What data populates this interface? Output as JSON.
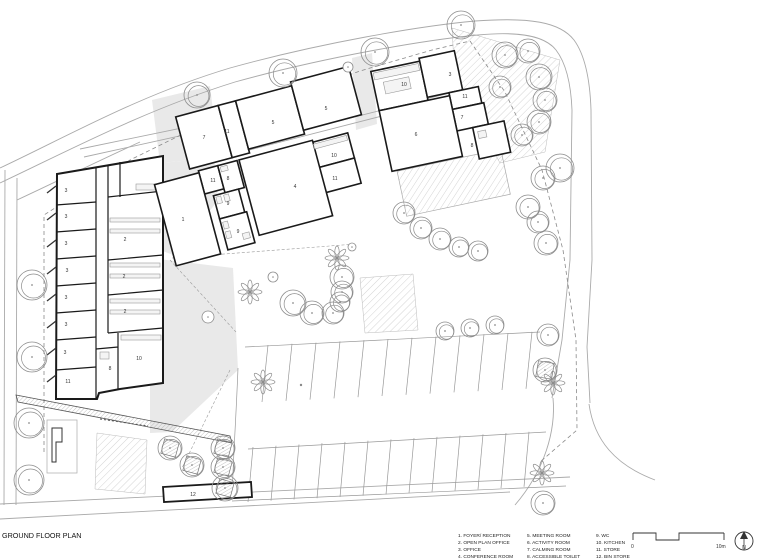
{
  "sheet": {
    "title": "GROUND FLOOR PLAN"
  },
  "legend": {
    "columns": [
      {
        "items": [
          "1. FOYER/ RECEPTION",
          "2. OPEN PLAN OFFICE",
          "3. OFFICE",
          "4. CONFERENCE ROOM"
        ]
      },
      {
        "items": [
          "5. MEETING ROOM",
          "6. ACTIVITY ROOM",
          "7. CALMING ROOM",
          "8. ACCESSIBLE TOILET"
        ]
      },
      {
        "items": [
          "9. WC",
          "10. KITCHEN",
          "11. STORE",
          "12. BIN STORE"
        ]
      }
    ]
  },
  "scale_bar": {
    "start_label": "0",
    "end_label": "10m"
  },
  "north_arrow": {
    "label": "N"
  },
  "plan": {
    "room_labels": [
      {
        "n": "3",
        "x": 66,
        "y": 192
      },
      {
        "n": "3",
        "x": 66,
        "y": 218
      },
      {
        "n": "3",
        "x": 66,
        "y": 245
      },
      {
        "n": "3",
        "x": 67,
        "y": 272
      },
      {
        "n": "3",
        "x": 66,
        "y": 299
      },
      {
        "n": "3",
        "x": 66,
        "y": 326
      },
      {
        "n": "3",
        "x": 65,
        "y": 354
      },
      {
        "n": "11",
        "x": 68,
        "y": 383
      },
      {
        "n": "2",
        "x": 125,
        "y": 241
      },
      {
        "n": "2",
        "x": 124,
        "y": 278
      },
      {
        "n": "2",
        "x": 125,
        "y": 313
      },
      {
        "n": "10",
        "x": 139,
        "y": 360
      },
      {
        "n": "8",
        "x": 110,
        "y": 370
      },
      {
        "n": "7",
        "x": 204,
        "y": 139
      },
      {
        "n": "11",
        "x": 227,
        "y": 133
      },
      {
        "n": "5",
        "x": 273,
        "y": 124
      },
      {
        "n": "5",
        "x": 326,
        "y": 110
      },
      {
        "n": "10",
        "x": 334,
        "y": 157
      },
      {
        "n": "11",
        "x": 335,
        "y": 180
      },
      {
        "n": "4",
        "x": 295,
        "y": 188
      },
      {
        "n": "11",
        "x": 213,
        "y": 182
      },
      {
        "n": "8",
        "x": 228,
        "y": 180
      },
      {
        "n": "9",
        "x": 228,
        "y": 205
      },
      {
        "n": "9",
        "x": 238,
        "y": 233
      },
      {
        "n": "1",
        "x": 183,
        "y": 221
      },
      {
        "n": "10",
        "x": 404,
        "y": 86
      },
      {
        "n": "3",
        "x": 450,
        "y": 76
      },
      {
        "n": "11",
        "x": 465,
        "y": 98
      },
      {
        "n": "7",
        "x": 462,
        "y": 119
      },
      {
        "n": "6",
        "x": 416,
        "y": 136
      },
      {
        "n": "8",
        "x": 472,
        "y": 147
      },
      {
        "n": "12",
        "x": 193,
        "y": 496
      }
    ]
  }
}
